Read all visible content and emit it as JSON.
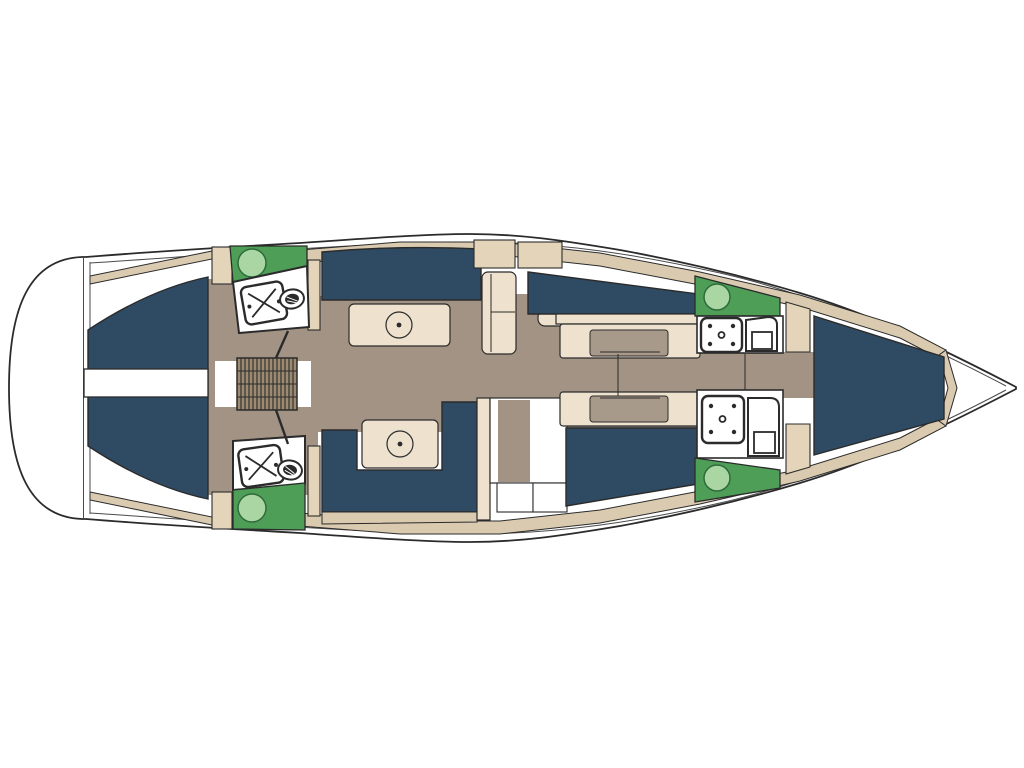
{
  "diagram": {
    "kind": "sailing-yacht-interior-deck-plan",
    "orientation": "bow-right-stern-left",
    "canvas": {
      "width": 1024,
      "height": 768
    }
  },
  "colors": {
    "white": "#ffffff",
    "ink": "#2b2b2b",
    "ink2": "#4a4a4a",
    "navy": "#2f4a63",
    "floor": "#a29385",
    "mattress": "#a89a8b",
    "deckTan": "#dacbb0",
    "blockTan": "#e3d4ba",
    "cream": "#eee2cf",
    "green": "#4f9e58",
    "greenLight": "#a9d6a3",
    "greenDark": "#2e6b3a",
    "gridBrown": "#9c8a72"
  },
  "legend": {
    "regions": [
      "swim-platform",
      "transom-walkway",
      "stern-lounge-port",
      "stern-lounge-starboard",
      "companionway-steps",
      "aft-head-port",
      "aft-head-starboard",
      "saloon-sofa-port",
      "saloon-sofa-starboard",
      "saloon-table-port",
      "saloon-table-starboard",
      "galley-port",
      "nav-station-starboard",
      "midship-cabin-port",
      "midship-cabin-starboard",
      "forward-head-port",
      "forward-head-starboard",
      "bow-v-berth",
      "side-deck"
    ],
    "fixtures": [
      "shower-tray",
      "toilet",
      "washbasin",
      "table-pedestal",
      "berth-mattress"
    ]
  }
}
